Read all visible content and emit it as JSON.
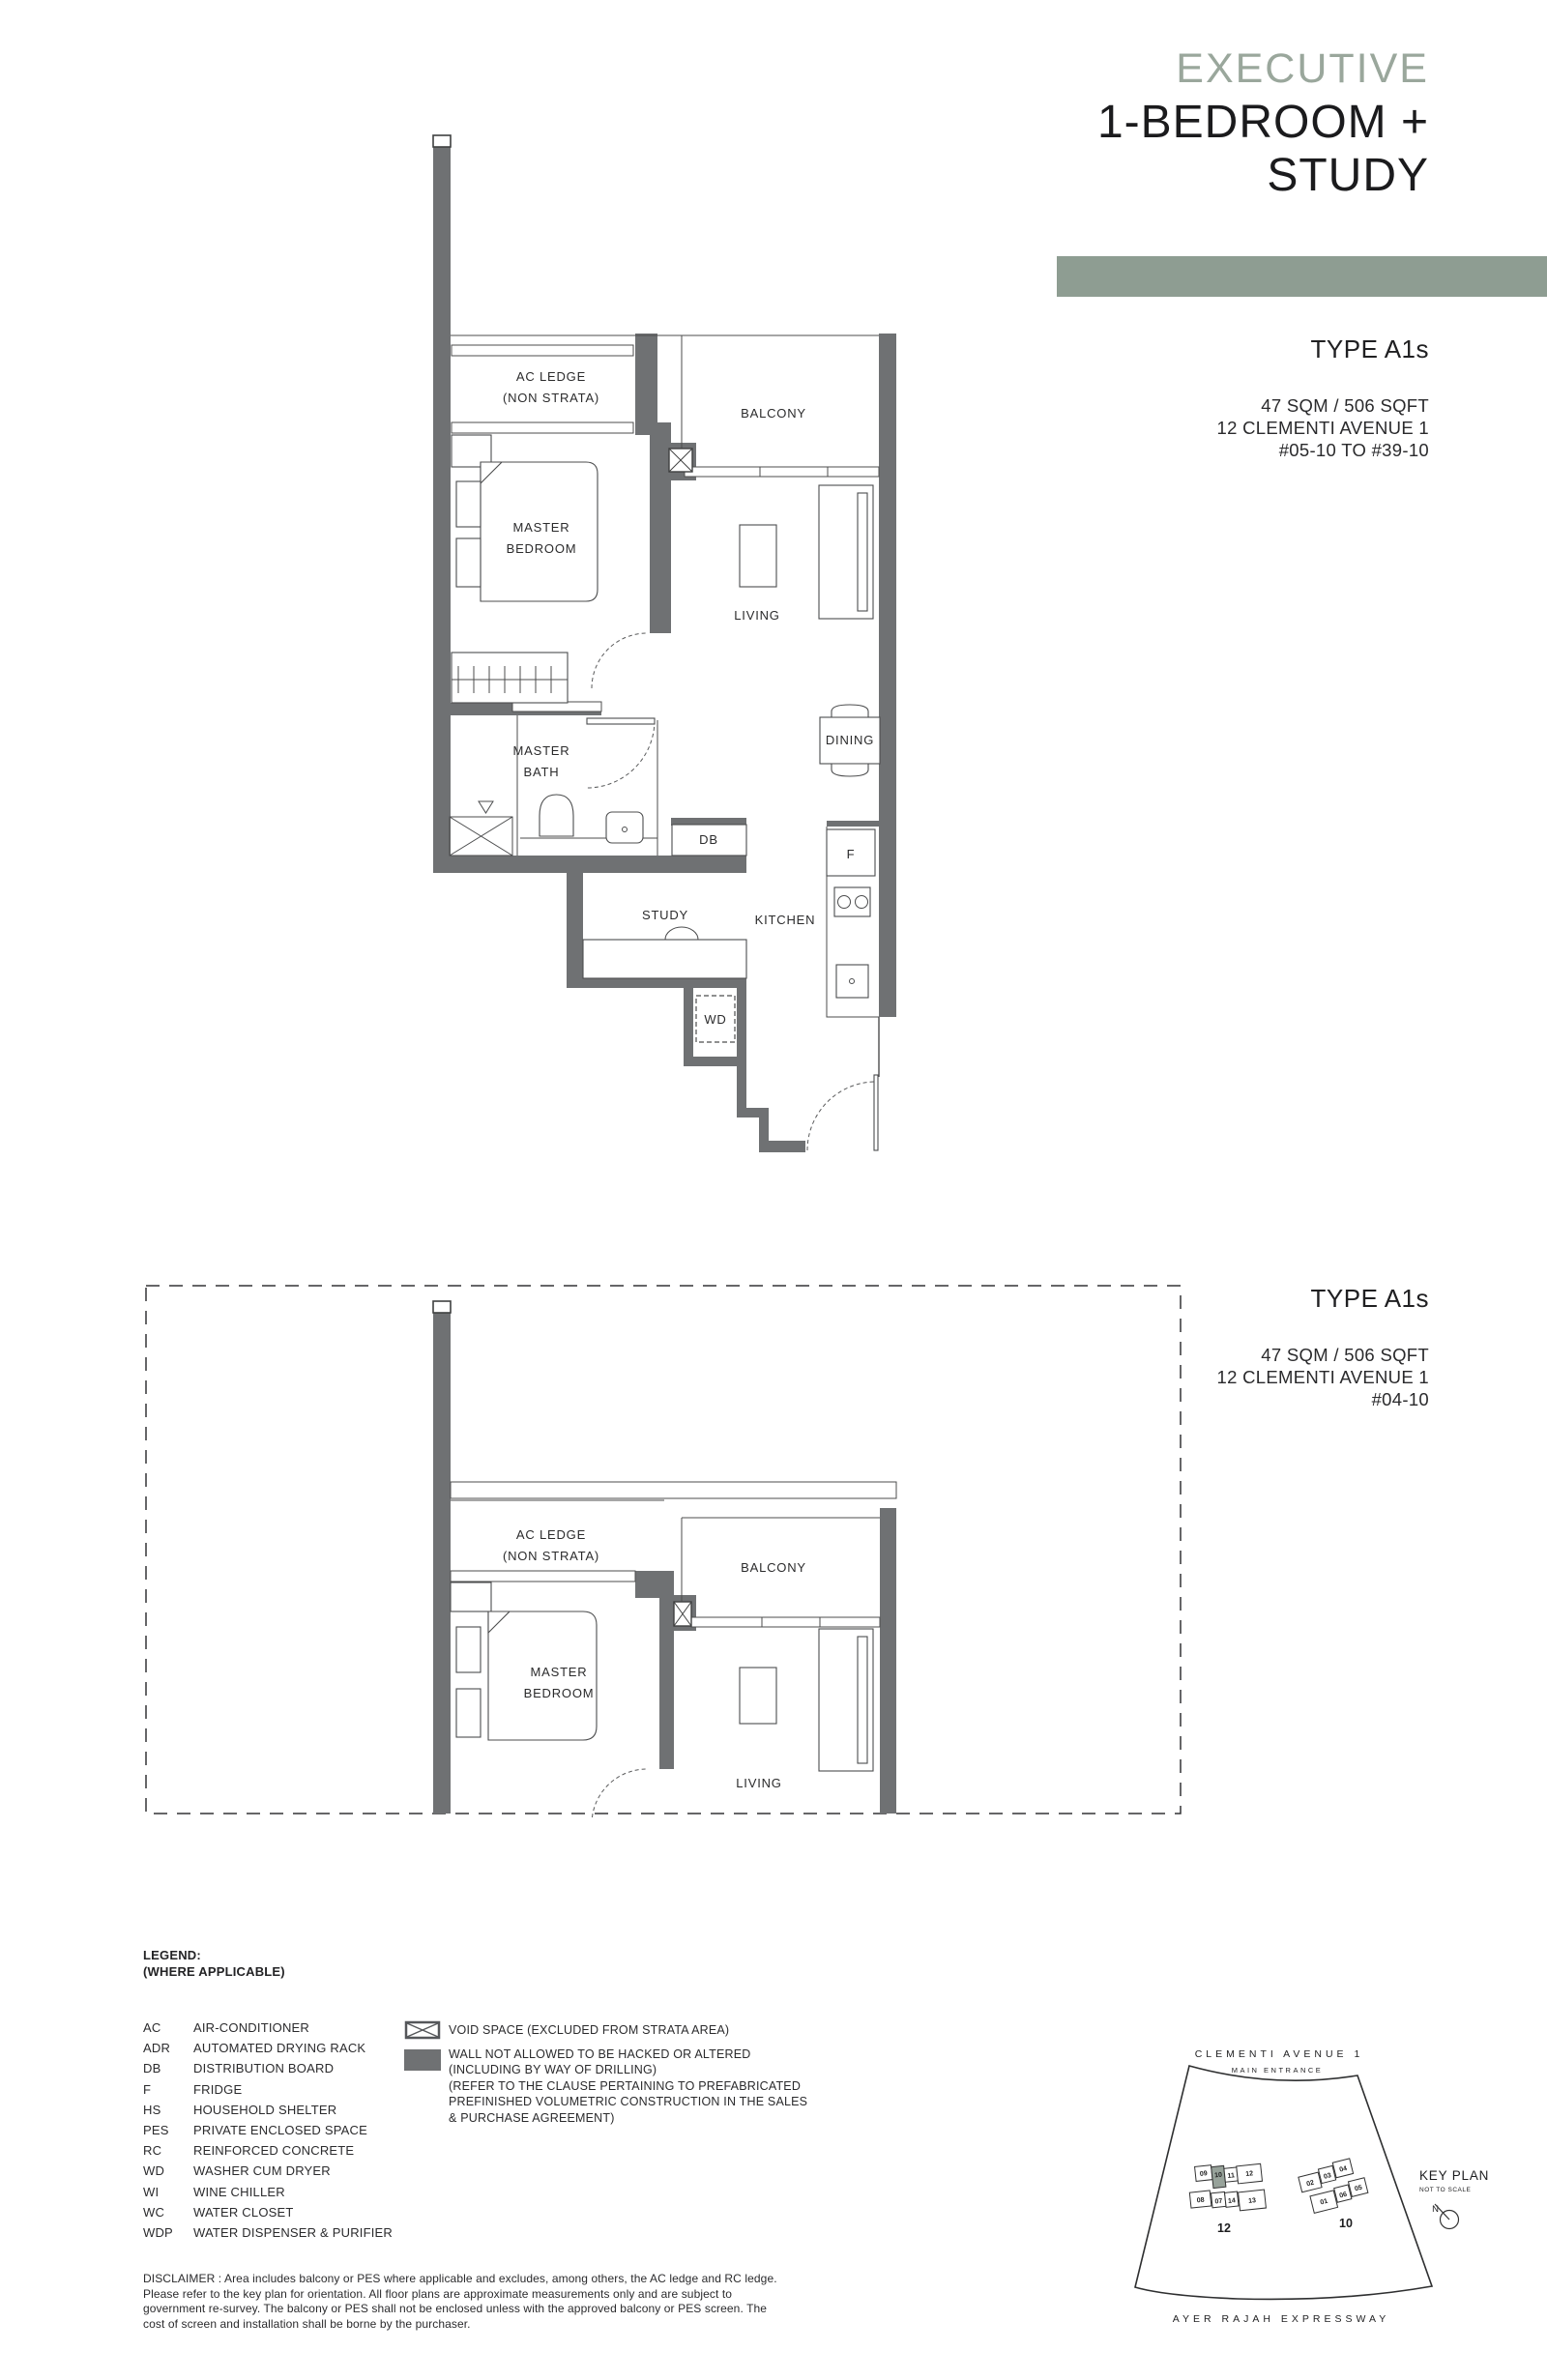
{
  "header": {
    "series": "EXECUTIVE",
    "title_line1": "1-BEDROOM +",
    "title_line2": "STUDY"
  },
  "colors": {
    "accent": "#8e9d92",
    "series_text": "#9aa79c",
    "wall": "#6f7173"
  },
  "plan_top": {
    "type": "TYPE A1s",
    "area": "47 SQM / 506 SQFT",
    "address": "12 CLEMENTI AVENUE 1",
    "stack": "#05-10 TO #39-10",
    "labels": {
      "ac_ledge": [
        "AC LEDGE",
        "(NON STRATA)"
      ],
      "balcony": "BALCONY",
      "master_bedroom": [
        "MASTER",
        "BEDROOM"
      ],
      "living": "LIVING",
      "dining": "DINING",
      "master_bath": [
        "MASTER",
        "BATH"
      ],
      "db": "DB",
      "fridge": "F",
      "study": "STUDY",
      "kitchen": "KITCHEN",
      "wd": "WD"
    }
  },
  "plan_bottom": {
    "type": "TYPE A1s",
    "area": "47 SQM / 506 SQFT",
    "address": "12 CLEMENTI AVENUE 1",
    "stack": "#04-10",
    "labels": {
      "ac_ledge": [
        "AC LEDGE",
        "(NON STRATA)"
      ],
      "balcony": "BALCONY",
      "master_bedroom": [
        "MASTER",
        "BEDROOM"
      ],
      "living": "LIVING"
    }
  },
  "legend": {
    "title": "LEGEND:",
    "subtitle": "(WHERE APPLICABLE)",
    "items": [
      {
        "abbr": "AC",
        "label": "AIR-CONDITIONER"
      },
      {
        "abbr": "ADR",
        "label": "AUTOMATED DRYING RACK"
      },
      {
        "abbr": "DB",
        "label": "DISTRIBUTION BOARD"
      },
      {
        "abbr": "F",
        "label": "FRIDGE"
      },
      {
        "abbr": "HS",
        "label": "HOUSEHOLD SHELTER"
      },
      {
        "abbr": "PES",
        "label": "PRIVATE ENCLOSED SPACE"
      },
      {
        "abbr": "RC",
        "label": "REINFORCED CONCRETE"
      },
      {
        "abbr": "WD",
        "label": "WASHER CUM DRYER"
      },
      {
        "abbr": "WI",
        "label": "WINE CHILLER"
      },
      {
        "abbr": "WC",
        "label": "WATER CLOSET"
      },
      {
        "abbr": "WDP",
        "label": "WATER DISPENSER & PURIFIER"
      }
    ],
    "void_label": "VOID SPACE (EXCLUDED FROM STRATA AREA)",
    "wall_label_lines": [
      "WALL NOT ALLOWED TO BE HACKED OR ALTERED",
      "(INCLUDING BY WAY OF DRILLING)",
      "(REFER TO THE CLAUSE PERTAINING TO PREFABRICATED",
      "PREFINISHED VOLUMETRIC CONSTRUCTION IN THE SALES",
      "& PURCHASE AGREEMENT)"
    ]
  },
  "disclaimer": "DISCLAIMER : Area includes balcony or PES where applicable and excludes, among others, the AC ledge and RC ledge. Please refer to the key plan for orientation. All floor plans are approximate measurements only and are subject to government re-survey. The balcony or PES shall not be enclosed unless with the approved balcony or PES screen. The cost of screen and installation shall be borne by the purchaser.",
  "keyplan": {
    "title": "KEY PLAN",
    "subtitle": "NOT TO SCALE",
    "north_label": "N",
    "road_top": "CLEMENTI  AVENUE 1",
    "main_entrance": "MAIN ENTRANCE",
    "road_bottom": "AYER  RAJAH  EXPRESSWAY",
    "block_left_label": "12",
    "block_right_label": "10",
    "block_left_units_top": [
      "09",
      "10",
      "11",
      "12"
    ],
    "block_left_units_bottom": [
      "08",
      "07",
      "14",
      "13"
    ],
    "block_right_units_top": [
      "02",
      "03",
      "04"
    ],
    "block_right_units_bottom": [
      "01",
      "06",
      "05"
    ],
    "highlighted_unit": "10",
    "highlight_color": "#97a29a"
  }
}
